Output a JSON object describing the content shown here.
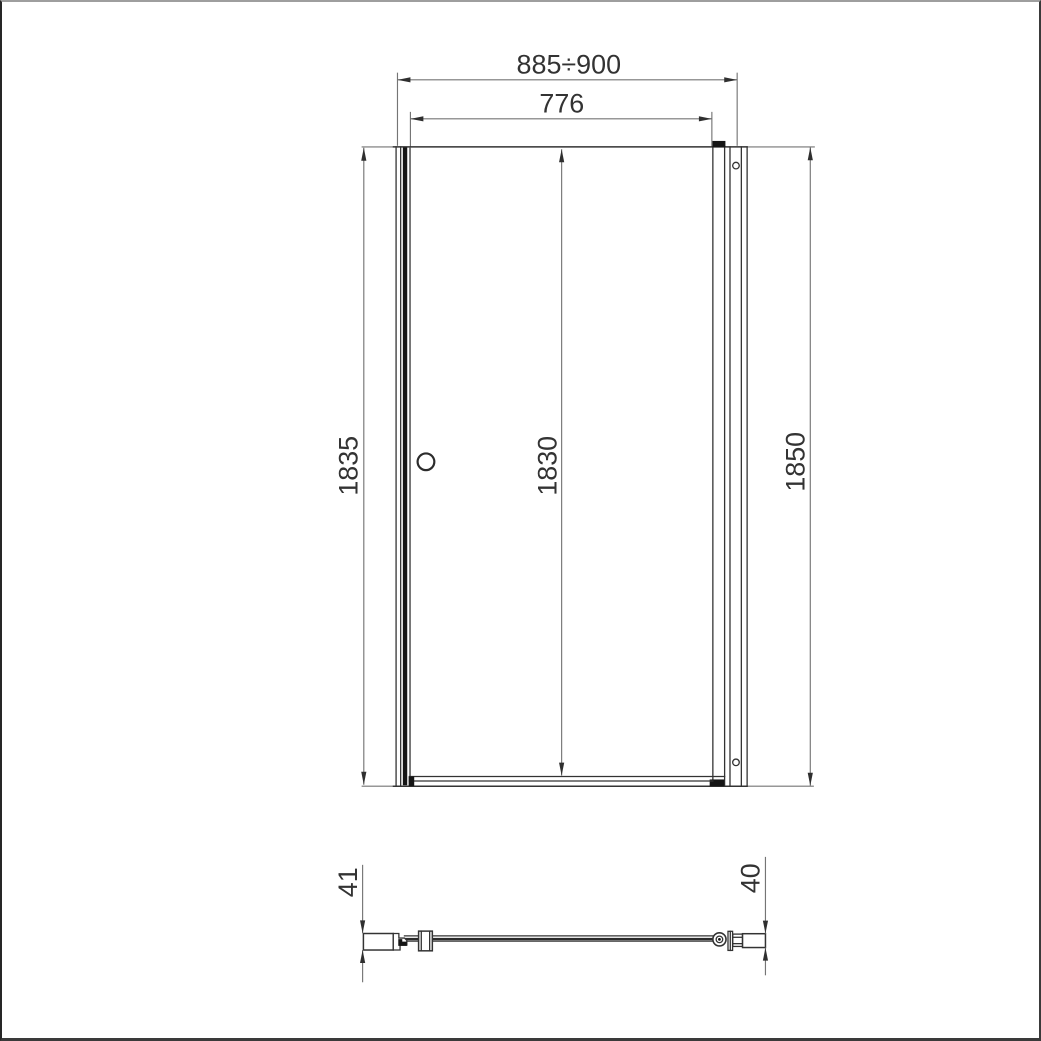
{
  "colors": {
    "line_color": "#333333",
    "dim_color": "#757575",
    "arrow_color": "#2f2f2f",
    "text_color": "#333333",
    "background": "#ffffff"
  },
  "front_view": {
    "overall_width": "885÷900",
    "door_glass_width": "776",
    "height_left": "1835",
    "height_door": "1830",
    "height_right": "1850"
  },
  "section_view": {
    "left_profile_depth": "41",
    "right_profile_depth": "40"
  }
}
